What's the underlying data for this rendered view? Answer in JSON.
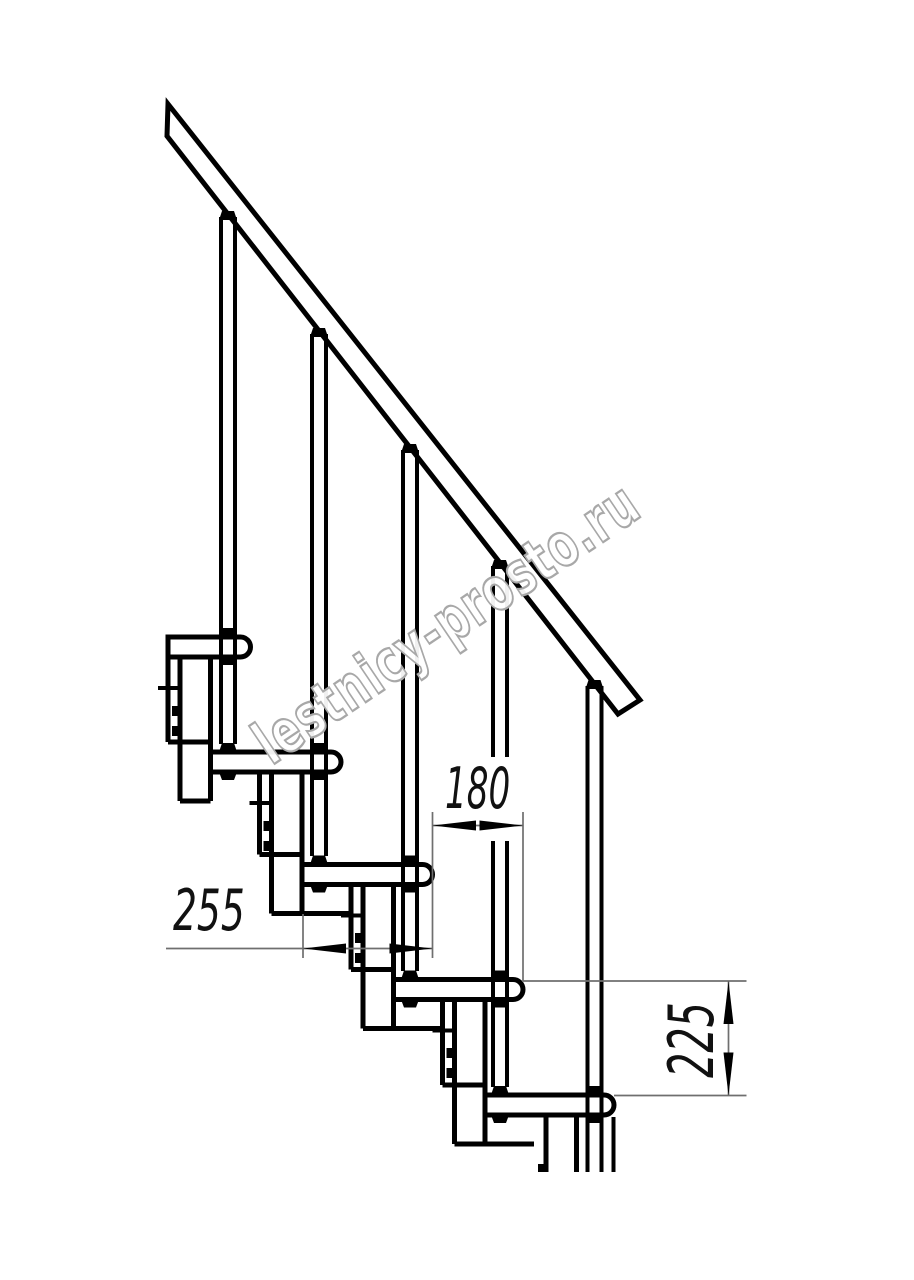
{
  "drawing": {
    "type": "staircase-side-elevation",
    "watermark": "lestnicy-prosto.ru",
    "dimensions": [
      {
        "id": "step-run-offset",
        "value": "180",
        "orientation": "horizontal"
      },
      {
        "id": "tread-depth",
        "value": "255",
        "orientation": "horizontal"
      },
      {
        "id": "step-rise",
        "value": "225",
        "orientation": "vertical"
      }
    ],
    "colors": {
      "outline": "#000000",
      "dimension_line": "#6f6f6f",
      "text": "#111111",
      "watermark": "#a8a8a8",
      "background": "#ffffff"
    }
  }
}
